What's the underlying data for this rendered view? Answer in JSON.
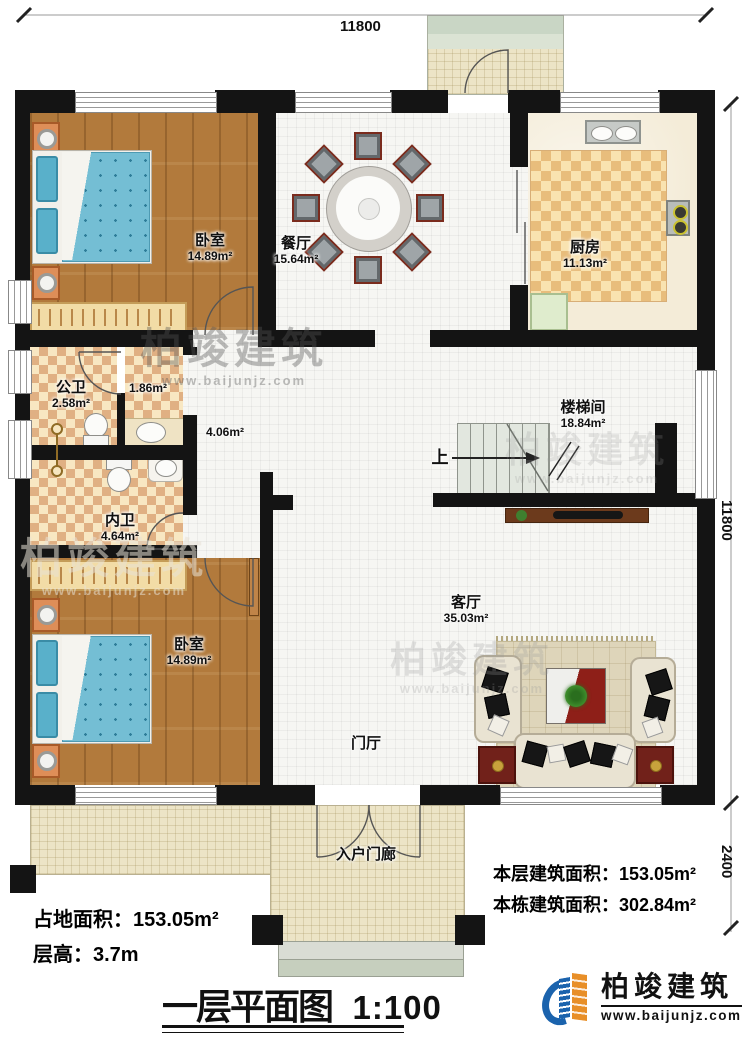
{
  "dimensions": {
    "top": "11800",
    "right_main": "11800",
    "right_porch": "2400"
  },
  "rooms": {
    "bedroom1": {
      "name": "卧室",
      "area": "14.89m²"
    },
    "dining": {
      "name": "餐厅",
      "area": "15.64m²"
    },
    "kitchen": {
      "name": "厨房",
      "area": "11.13m²"
    },
    "public_bath": {
      "name": "公卫",
      "area": "2.58m²"
    },
    "vestibule": {
      "area": "1.86m²"
    },
    "hallway": {
      "area": "4.06m²"
    },
    "ensuite_bath": {
      "name": "内卫",
      "area": "4.64m²"
    },
    "stairwell": {
      "name": "楼梯间",
      "area": "18.84m²"
    },
    "living": {
      "name": "客厅",
      "area": "35.03m²"
    },
    "bedroom2": {
      "name": "卧室",
      "area": "14.89m²"
    },
    "foyer": {
      "name": "门厅"
    },
    "entry_porch": {
      "name": "入户门廊"
    }
  },
  "stair_up_label": "上",
  "stats": {
    "land_area": "占地面积：153.05m²",
    "floor_height": "层高：3.7m",
    "floor_area": "本层建筑面积：153.05m²",
    "total_area": "本栋建筑面积：302.84m²"
  },
  "title": {
    "name": "一层平面图",
    "scale": "1:100"
  },
  "brand": {
    "name": "柏竣建筑",
    "url": "www.baijunjz.com"
  },
  "watermark": {
    "name": "柏竣建筑",
    "url": "www.baijunjz.com"
  }
}
